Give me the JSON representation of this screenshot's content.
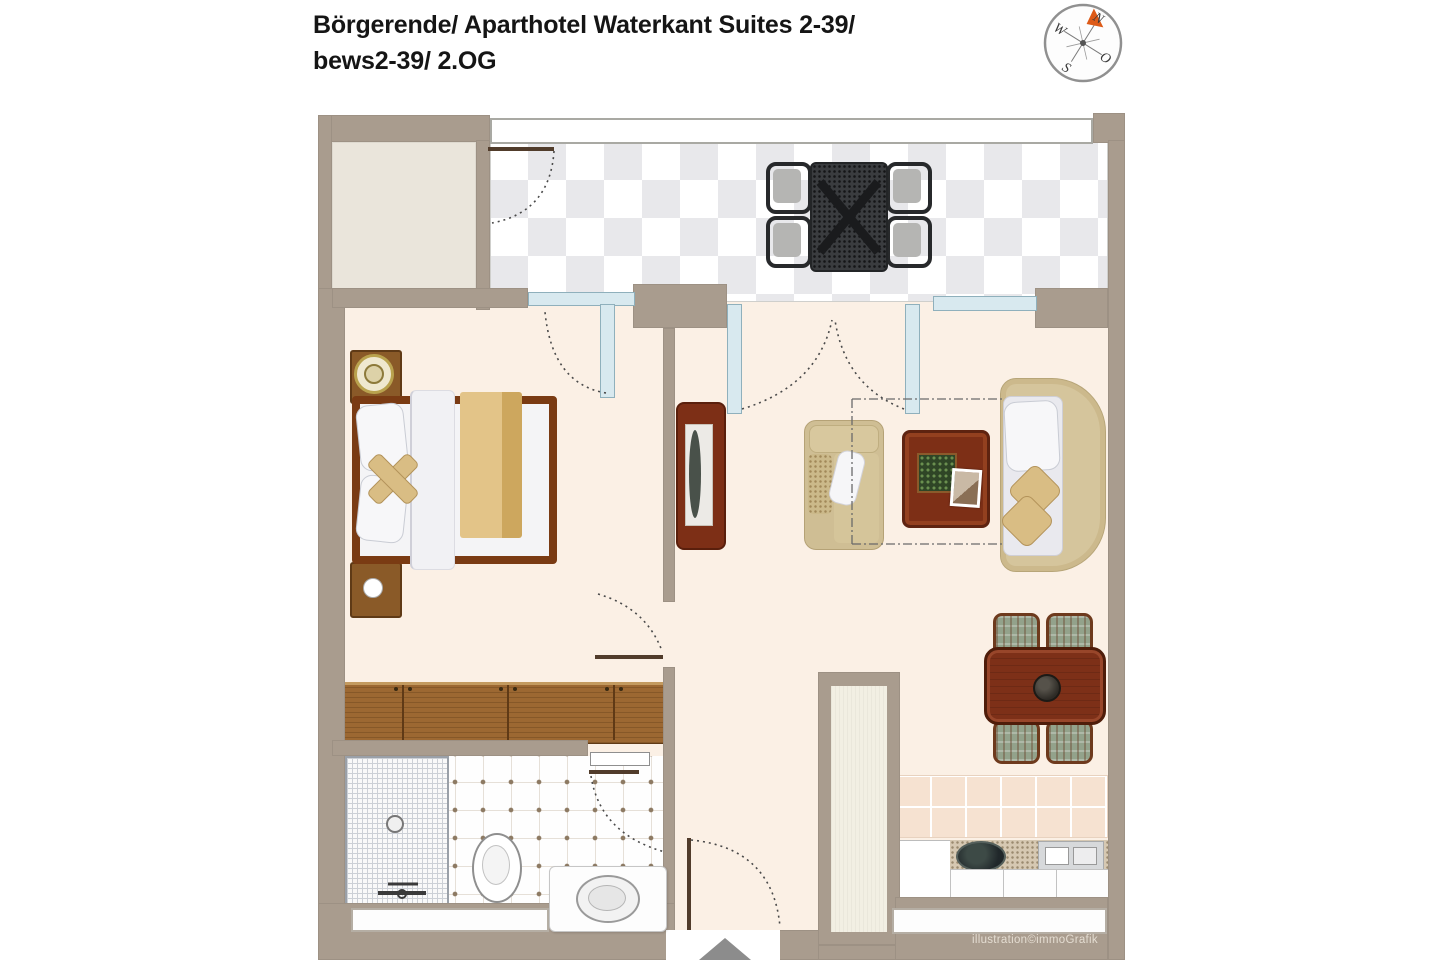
{
  "header": {
    "title_line1": "Börgerende/ Aparthotel Waterkant Suites 2-39/",
    "title_line2": "bews2-39/ 2.OG"
  },
  "compass": {
    "north": "N",
    "east": "O",
    "south": "S",
    "west": "W"
  },
  "footer": {
    "credit": "illustration©immoGrafik"
  },
  "colors": {
    "wall": "#a99c8e",
    "floor": "#fbf0e5",
    "niche_floor": "#eae5db",
    "balcony_tile": "#e8e8eb",
    "wood_dark": "#7d2f16",
    "wood_light": "#9c6832",
    "fabric_tan": "#d9bd84",
    "glass": "#d8e9ef",
    "accent_orange": "#dd5a17"
  }
}
